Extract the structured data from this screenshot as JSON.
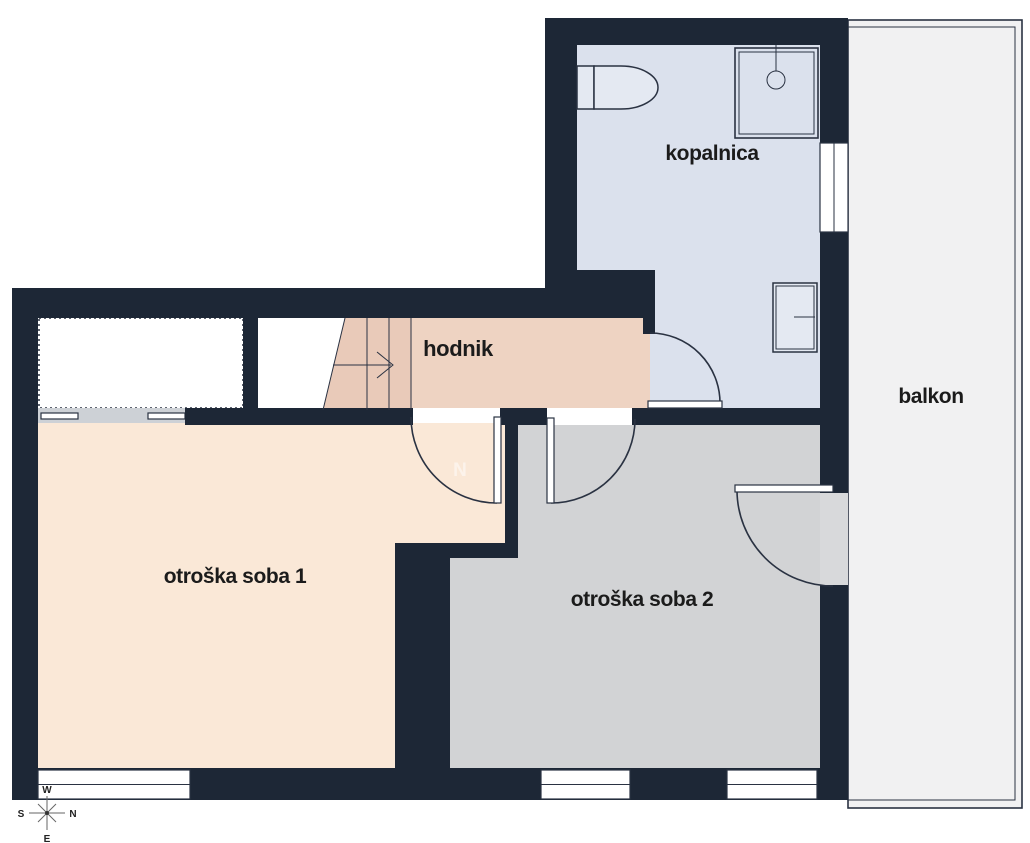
{
  "plan": {
    "type": "floor-plan",
    "rooms": [
      {
        "id": "kopalnica",
        "label": "kopalnica",
        "color": "#dbe1ed"
      },
      {
        "id": "hodnik",
        "label": "hodnik",
        "color": "#eed3c2"
      },
      {
        "id": "balkon",
        "label": "balkon",
        "color": "#f1f1f2"
      },
      {
        "id": "soba1",
        "label": "otroška soba 1",
        "color": "#fae8d7"
      },
      {
        "id": "soba2",
        "label": "otroška soba 2",
        "color": "#d2d3d5"
      }
    ],
    "fixtures": [
      "toilet",
      "shower",
      "radiator",
      "stairs"
    ],
    "watermark": "N"
  },
  "compass": {
    "west": "W",
    "north": "N",
    "south": "S",
    "east": "E"
  },
  "colors": {
    "wall": "#1d2736",
    "line": "#2a3242",
    "kopalnica": "#dbe1ed",
    "hodnik": "#eed3c2",
    "stairs": "#e9cab9",
    "soba1": "#fae8d7",
    "soba2": "#d2d3d5",
    "balkon": "#f1f1f2",
    "lowwall": "#cdd1d6",
    "gap": "#d8d9db",
    "door": "#ffffff",
    "fixture": "#e4e9f2",
    "label": "#1b1b1b",
    "watermark": "#ffffff"
  }
}
